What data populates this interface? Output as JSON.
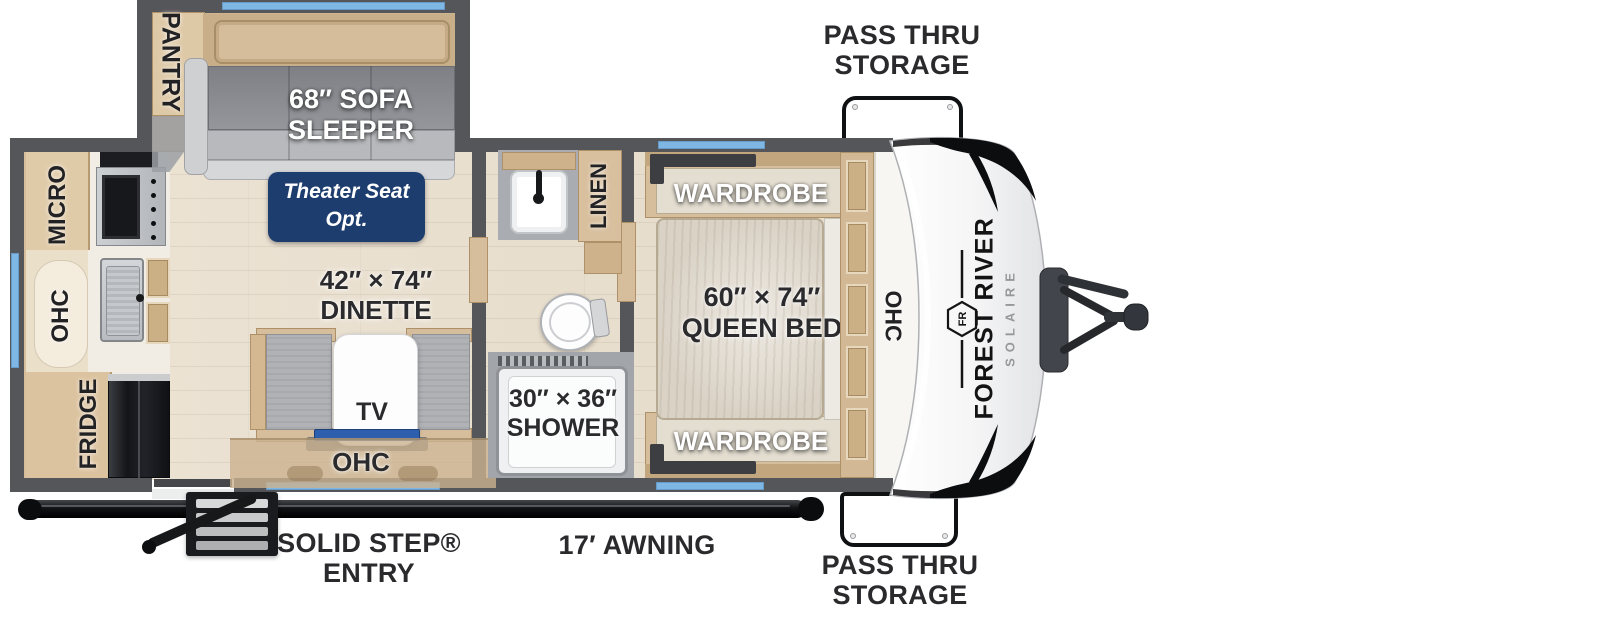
{
  "colors": {
    "wall_gray": "#55565a",
    "floor_beige": "#e9e0d1",
    "window_blue": "#7eb6e4",
    "cabinet_tan": "#d6bd9b",
    "badge_navy": "#1d3d6e",
    "tv_blue": "#2e5fae",
    "label_dark": "#2a2a2d",
    "solaire_gray": "#96989b",
    "frame_black": "#121316"
  },
  "exterior": {
    "pass_thru_top": {
      "line1": "PASS THRU",
      "line2": "STORAGE"
    },
    "pass_thru_bottom": {
      "line1": "PASS THRU",
      "line2": "STORAGE"
    },
    "entry": {
      "line1": "SOLID STEP®",
      "line2": "ENTRY"
    },
    "awning_label": "17′ AWNING"
  },
  "brand": {
    "maker": "FOREST RIVER",
    "model": "SOLAIRE",
    "monogram": "FR"
  },
  "living": {
    "pantry": "PANTRY",
    "sofa_line1": "68″ SOFA",
    "sofa_line2": "SLEEPER",
    "theater_line1": "Theater Seat",
    "theater_line2": "Opt.",
    "dinette_line1": "42″ × 74″",
    "dinette_line2": "DINETTE",
    "tv": "TV",
    "ohc": "OHC"
  },
  "kitchen": {
    "micro": "MICRO",
    "ohc": "OHC",
    "fridge": "FRIDGE"
  },
  "bath": {
    "linen": "LINEN",
    "shower_line1": "30″ × 36″",
    "shower_line2": "SHOWER"
  },
  "bedroom": {
    "wardrobe_top": "WARDROBE",
    "wardrobe_bottom": "WARDROBE",
    "bed_line1": "60″ × 74″",
    "bed_line2": "QUEEN BED",
    "ohc": "OHC"
  }
}
